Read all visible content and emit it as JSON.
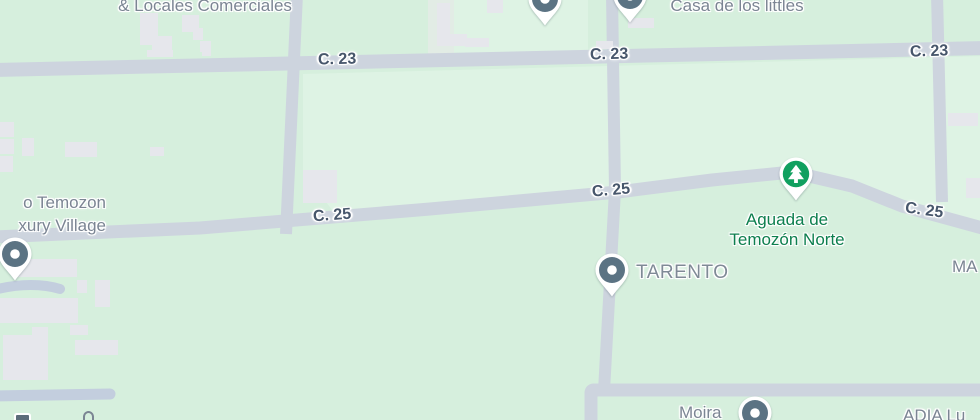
{
  "map": {
    "type": "street-map",
    "colors": {
      "background": "#d6efdd",
      "parcel": "#def3e4",
      "road": "#cdd4de",
      "driveway": "#c3cede",
      "building": "#e6e7ec",
      "road_label": "#47566b",
      "poi_label": "#7b8593",
      "park_label": "#0d7f4e",
      "poi_pin": "#5b7383",
      "park_pin": "#10a05f"
    },
    "road_labels": [
      {
        "label": "C. 23"
      },
      {
        "label": "C. 23"
      },
      {
        "label": "C. 23"
      },
      {
        "label": "C. 25"
      },
      {
        "label": "C. 25"
      },
      {
        "label": "C. 25"
      }
    ],
    "pois": [
      {
        "label": "& Locales Comerciales",
        "icon": "none"
      },
      {
        "label": "Casa de los littles",
        "icon": "poi-dot-pin"
      },
      {
        "line1": "o Temozon",
        "line2": "xury Village",
        "icon": "poi-dot-pin"
      },
      {
        "line1": "Aguada de",
        "line2": "Temozón Norte",
        "icon": "park-tree-pin"
      },
      {
        "label": "TARENTO",
        "icon": "poi-dot-pin"
      },
      {
        "label": "Moira",
        "icon": "poi-dot-pin"
      },
      {
        "label": "ADIA Lu",
        "icon": "none"
      },
      {
        "label": "MA",
        "icon": "none"
      }
    ]
  }
}
